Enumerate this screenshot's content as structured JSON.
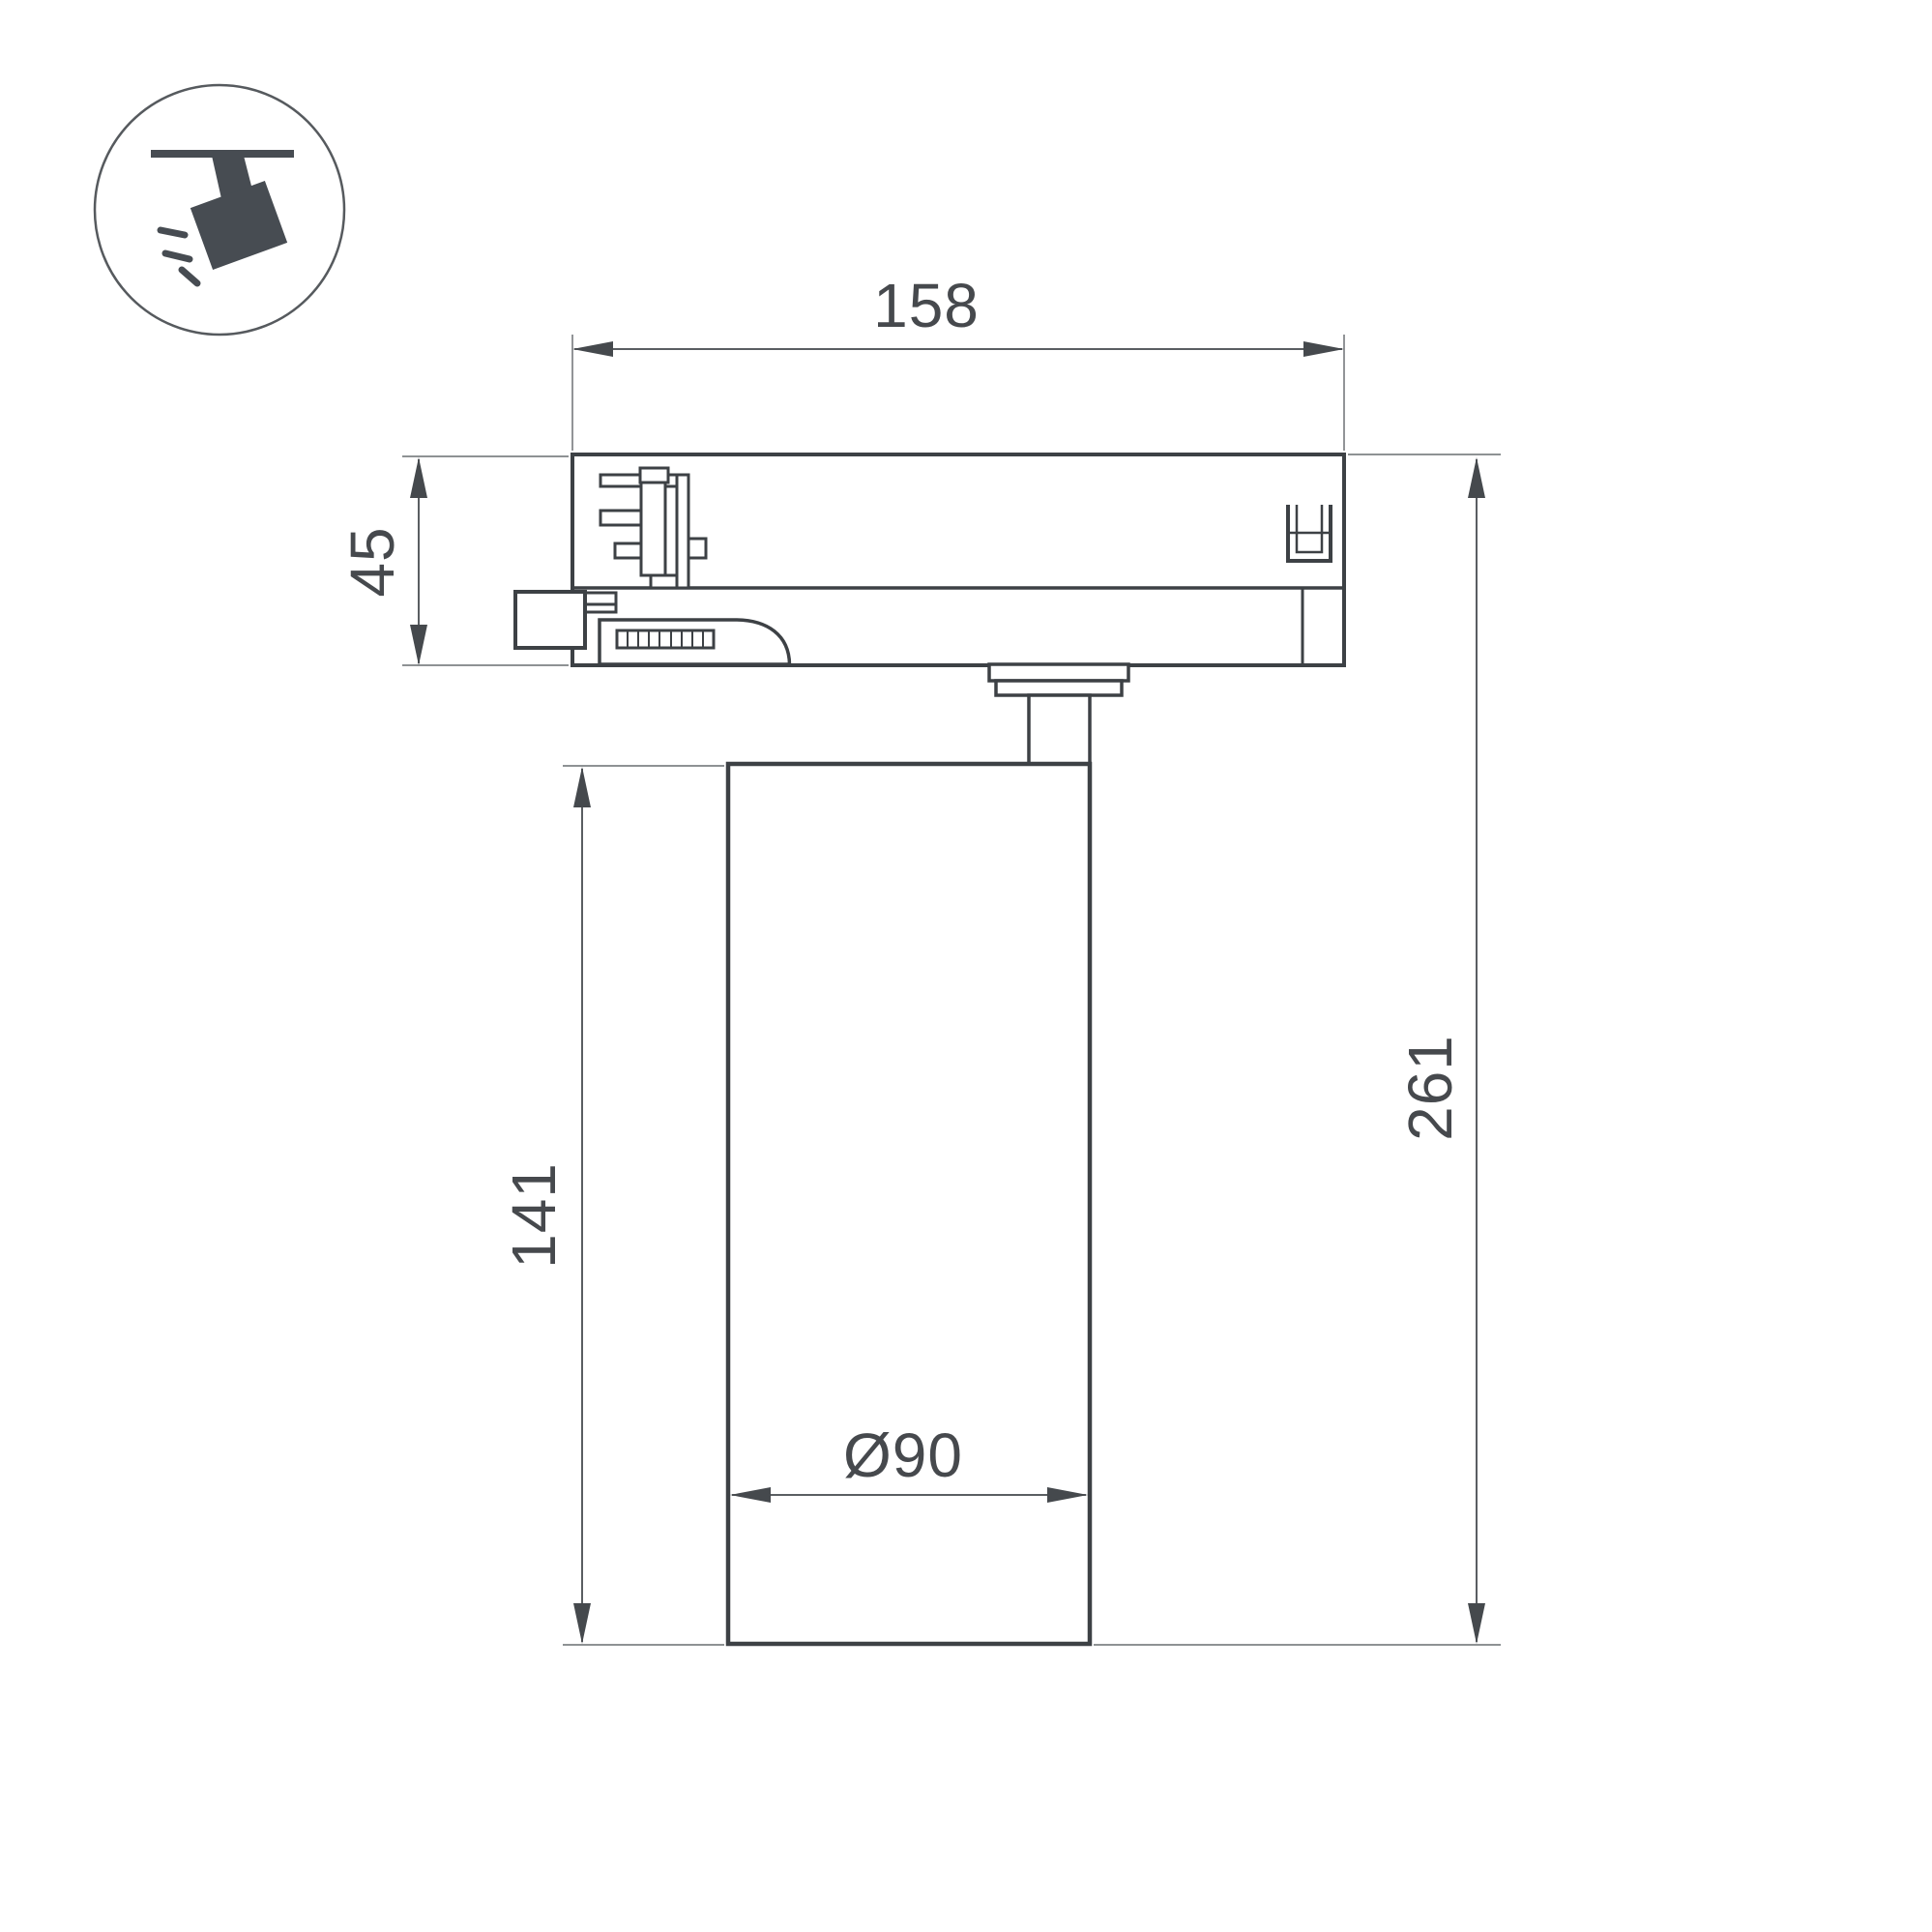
{
  "drawing": {
    "title": "Track spotlight dimensional drawing",
    "icon": {
      "label": "ceiling-track-spotlight"
    },
    "dimensions": {
      "track_adapter_width": "158",
      "track_adapter_height": "45",
      "body_height": "141",
      "total_height": "261",
      "body_diameter": "Ø90"
    },
    "units": "mm",
    "colors": {
      "background": "#ffffff",
      "outline": "#3d4145",
      "dimension_line": "#5a5e62",
      "extension_line": "#7e8285",
      "text": "#46494d",
      "icon": "#474c52"
    }
  }
}
